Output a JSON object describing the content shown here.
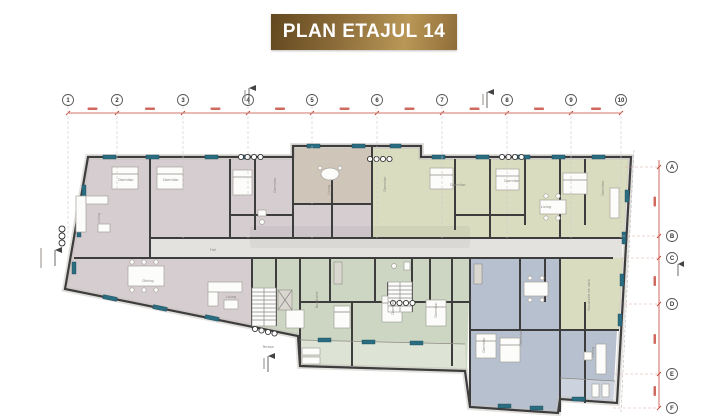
{
  "title": {
    "text": "PLAN ETAJUL 14"
  },
  "grid": {
    "top": [
      "1",
      "2",
      "3",
      "4",
      "5",
      "6",
      "7",
      "8",
      "9",
      "10"
    ],
    "right": [
      "A",
      "B",
      "C",
      "D",
      "E",
      "F"
    ]
  },
  "rooms": [
    "Living",
    "Dining",
    "Dormitor",
    "Dormitor",
    "Dormitor",
    "Living",
    "Dormitor",
    "Dormitor",
    "Dormitor",
    "Living",
    "Dormitor",
    "Bucatarie",
    "Dormitor",
    "Dormitor",
    "Living",
    "Terasa",
    "Dormitor",
    "Dormitor",
    "Living",
    "Bucatarie de vara",
    "Hol"
  ],
  "colors": {
    "banner_dark": "#63481f",
    "banner_light": "#b99757",
    "banner_text": "#ffffff",
    "wall": "#3d3d3d",
    "apartment_mauve": "#d6cdd1",
    "apartment_taupe": "#cfc6b9",
    "apartment_olive": "#dadcc0",
    "apartment_green": "#ccd6c2",
    "apartment_blue": "#b7c0ce",
    "corridor": "#e4e2df",
    "window_teal": "#2a6c80",
    "dimension_red": "#c44536",
    "furniture": "#fcfcfa"
  }
}
